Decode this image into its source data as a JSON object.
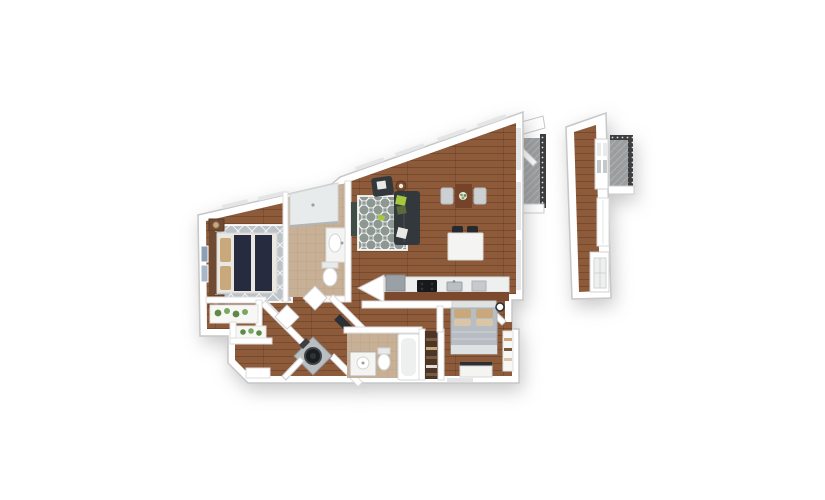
{
  "scene": {
    "description": "3D isometric floor plan render of a two-bedroom two-bathroom apartment with wood flooring, balcony, and a detached hallway segment with its own balcony",
    "rooms": [
      "bedroom-1",
      "bathroom-1",
      "living-room",
      "dining-area",
      "kitchen",
      "hallway",
      "entry",
      "laundry-closet",
      "bathroom-2",
      "bedroom-2",
      "closets",
      "balcony",
      "detached-segment"
    ],
    "furniture": [
      "bed",
      "nightstands",
      "lamps",
      "wall-art",
      "diamond-rug",
      "shower",
      "vanity-sink",
      "toilet",
      "tv-panel",
      "sectional-sofa",
      "armchair",
      "side-table",
      "trellis-rug",
      "dining-table",
      "dining-chairs",
      "kitchen-island",
      "bar-stools",
      "refrigerator",
      "cooktop",
      "kitchen-sink",
      "counter-slab",
      "washer",
      "bathtub",
      "linen-shelves",
      "queen-bed",
      "dresser",
      "wall-clock",
      "closet-shelves",
      "plants",
      "console-shelf",
      "balcony-railing",
      "window-grid"
    ]
  },
  "colors": {
    "wall": "#ffffff",
    "wall_stroke": "#c7c7c7",
    "inner_stroke": "#dddddd",
    "wood": "#8d5a3a",
    "wood_front": "#7b4a2e",
    "rug_living": "#8e9893",
    "rug_bed": "#bdc4c9",
    "sofa": "#33383d",
    "pillow_green": "#a5c83e",
    "pillow_green_dark": "#5a6c3c",
    "pillow_white": "#e9e9e6",
    "side_table": "#7a4a2c",
    "dining_table": "#74432a",
    "chair": "#ccd0d3",
    "island": "#f4f4f3",
    "stool": "#26292d",
    "counter": "#eef0f0",
    "fridge": "#9aa1a6",
    "stove": "#17191b",
    "sink": "#b9bfc2",
    "bath_floor": "#c7b096",
    "fixture": "#ffffff",
    "fixture_stroke": "#d2d6d6",
    "shower_tray": "#e8ebec",
    "tv": "#3f4d47",
    "headboard": "#6f4a33",
    "bed_navy": "#262b40",
    "bed_linen": "#e9e7e2",
    "tan": "#c9a87c",
    "tan_light": "#d9c6a8",
    "bed2_duvet": "#b7bdc3",
    "bed2_end": "#dfe2e3",
    "dresser": "#f4f4f2",
    "dresser_top": "#2c2f33",
    "washer_body": "#b9bec1",
    "washer_door": "#1b1e21",
    "shelf_dark": "#4a3526",
    "shelf_light": "#7a5a3c",
    "plant": "#5f8a46",
    "plant_light": "#7aa85c",
    "balcony_floor": "#9b9d9e",
    "railing": "#3c3e40",
    "glass": "#c3c8ca",
    "window_slot": "#e3e5e6",
    "art_blue": "#8e9fb5",
    "art_blue2": "#a8b6c8",
    "counter_slab": "#2c2f33",
    "shelf_white": "#f7f7f5"
  }
}
